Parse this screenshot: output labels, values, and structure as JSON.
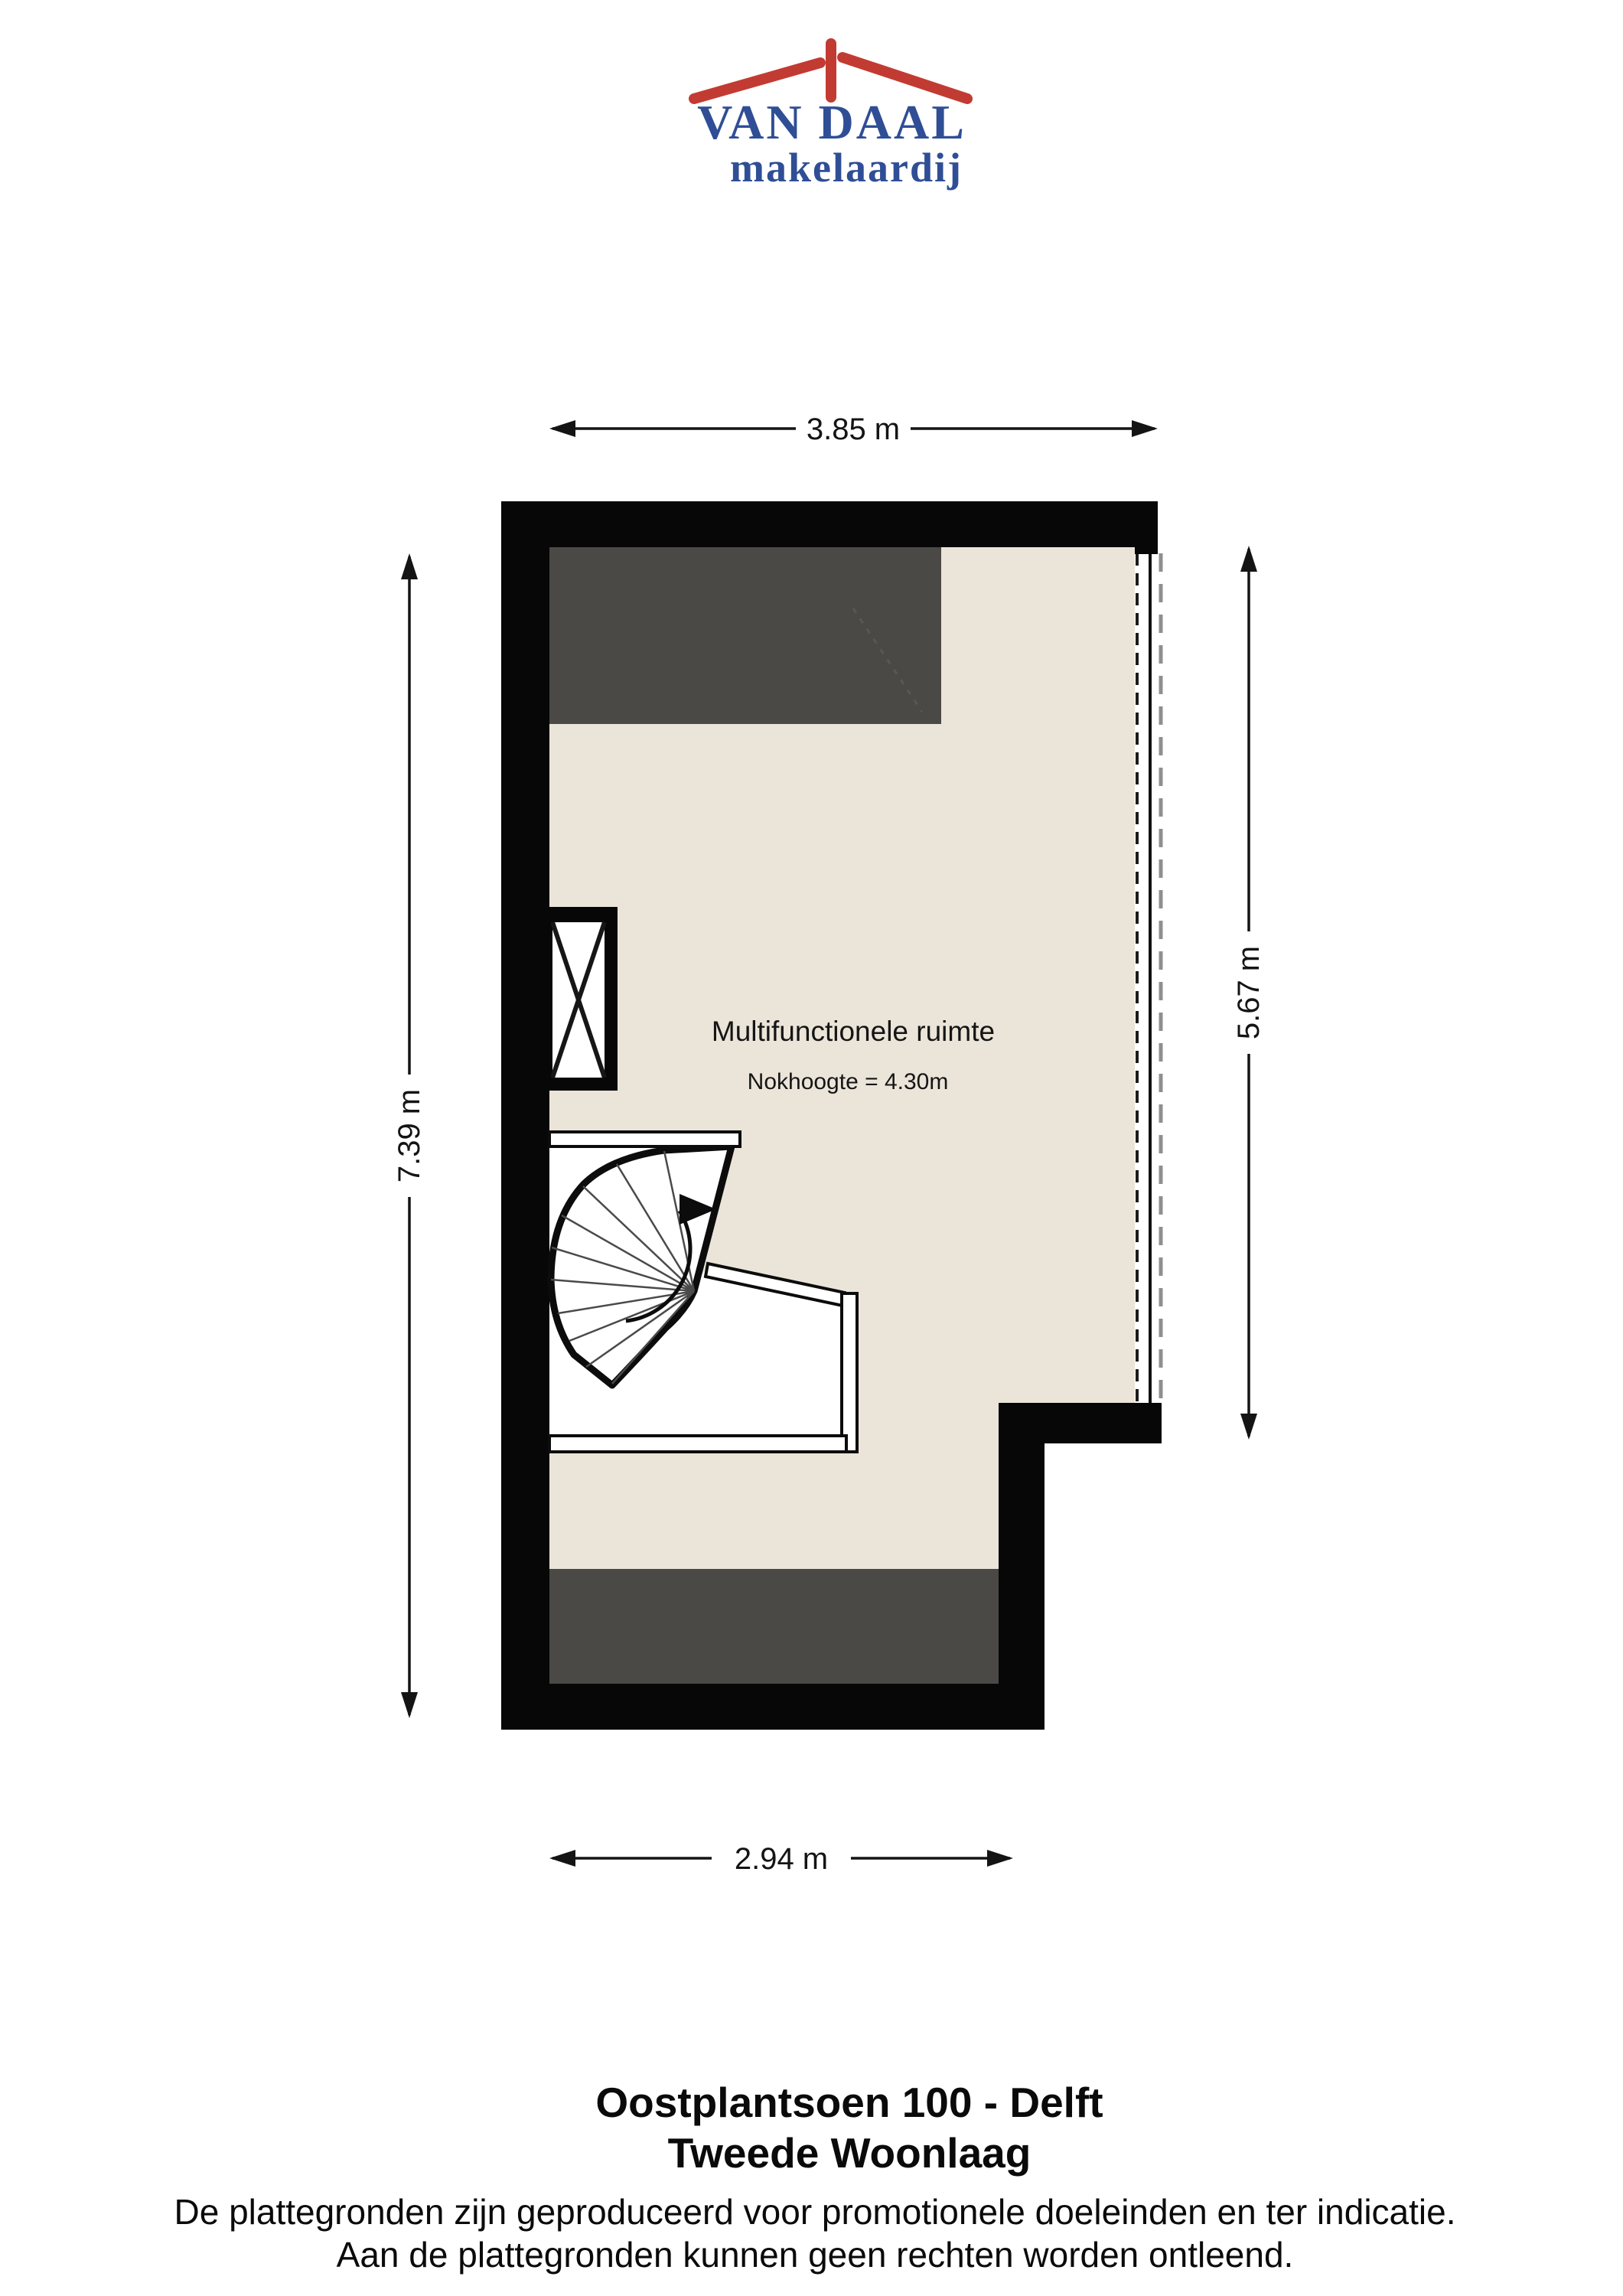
{
  "logo": {
    "title": "VAN DAAL",
    "subtitle": "makelaardij",
    "red": "#C23B32",
    "blue": "#2F4E96"
  },
  "dimensions": {
    "top": "3.85 m",
    "left": "7.39 m",
    "right": "5.67 m",
    "bottom": "2.94 m"
  },
  "room": {
    "name": "Multifunctionele ruimte",
    "height_note": "Nokhoogte = 4.30m"
  },
  "footer": {
    "address": "Oostplantsoen 100 - Delft",
    "floor_name": "Tweede Woonlaag",
    "disclaimer_line1": "De plattegronden zijn geproduceerd voor promotionele doeleinden en ter indicatie.",
    "disclaimer_line2": "Aan de plattegronden kunnen geen rechten worden ontleend."
  },
  "colors": {
    "floor": "#EBE4D9",
    "roof_area": "#4B4946",
    "wall": "#070707",
    "dimension": "#141414"
  }
}
